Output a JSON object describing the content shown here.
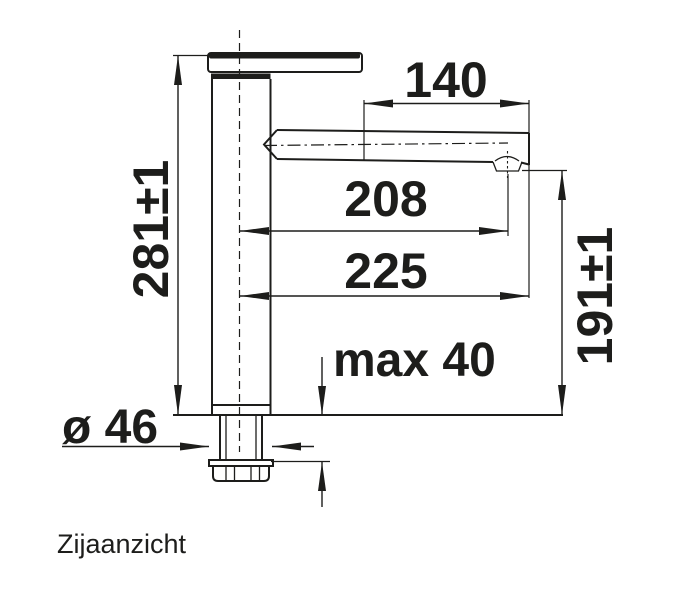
{
  "colors": {
    "line": "#1d1d1b",
    "background": "#ffffff"
  },
  "caption": "Zijaanzicht",
  "dimensions": {
    "head_length": "140",
    "reach_to_aerator": "208",
    "total_reach": "225",
    "total_height": "281±1",
    "spout_height": "191±1",
    "max_mounting_thickness": "max 40",
    "base_diameter": "ø 46"
  }
}
